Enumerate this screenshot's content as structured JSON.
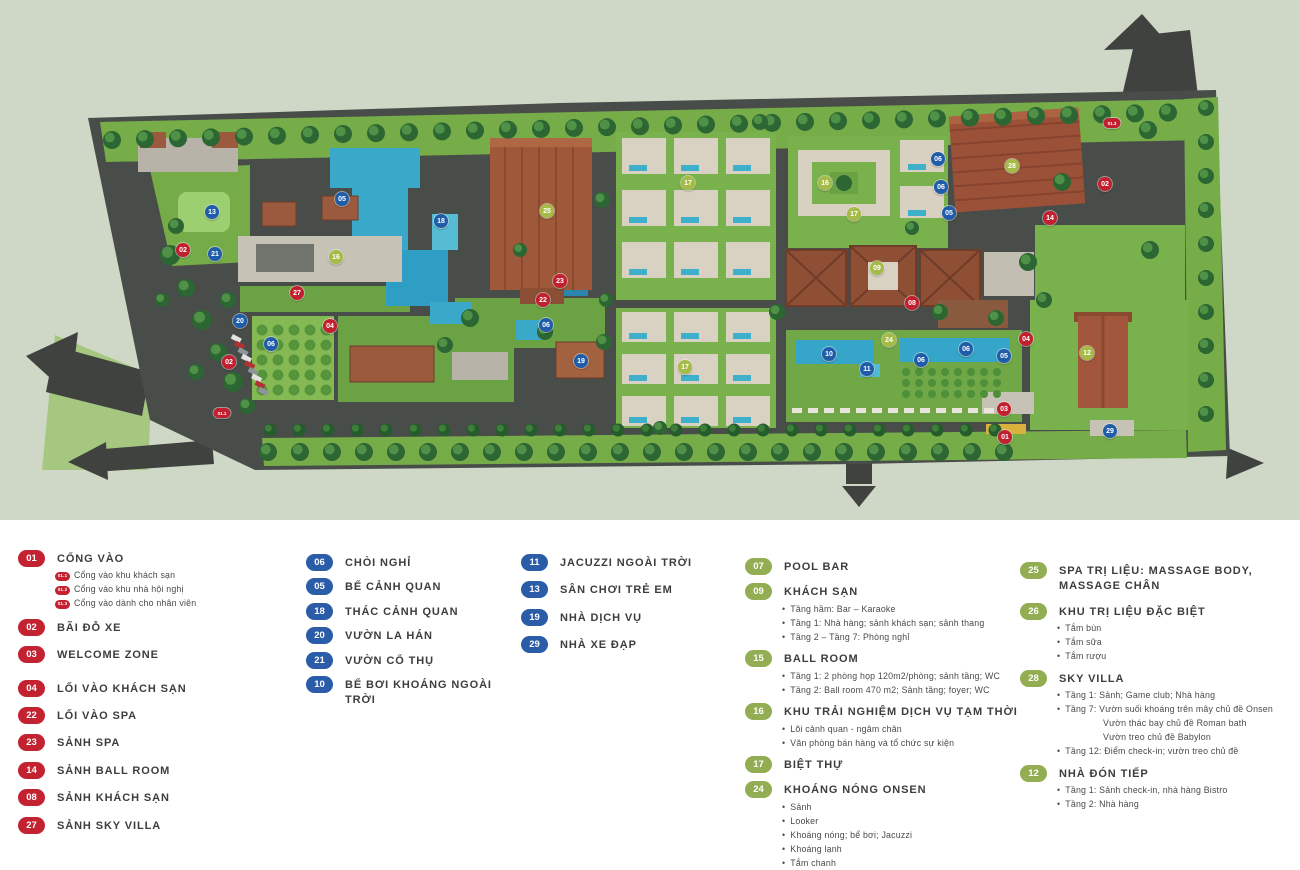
{
  "palette": {
    "map_background": "#cfd8c6",
    "site_ground": "#494d49",
    "lawn_green": "#77ad49",
    "pool_blue": "#3aa9c9",
    "roof_terracotta": "#9b5138",
    "marker_red": "#c3202f",
    "marker_blue": "#1f5dab",
    "marker_green": "#a4bb45",
    "legend_red": "#c32231",
    "legend_blue": "#2a5ca8",
    "legend_green": "#93ad52"
  },
  "map": {
    "markers": [
      {
        "num": "13",
        "color": "blue",
        "x": 212,
        "y": 212
      },
      {
        "num": "21",
        "color": "blue",
        "x": 215,
        "y": 254
      },
      {
        "num": "02",
        "color": "red",
        "x": 183,
        "y": 250
      },
      {
        "num": "02",
        "color": "red",
        "x": 229,
        "y": 362
      },
      {
        "num": "01.1",
        "color": "red",
        "x": 222,
        "y": 413,
        "small": true
      },
      {
        "num": "20",
        "color": "blue",
        "x": 240,
        "y": 321
      },
      {
        "num": "06",
        "color": "blue",
        "x": 271,
        "y": 344
      },
      {
        "num": "27",
        "color": "red",
        "x": 297,
        "y": 293
      },
      {
        "num": "04",
        "color": "red",
        "x": 330,
        "y": 326
      },
      {
        "num": "16",
        "color": "green",
        "x": 336,
        "y": 257
      },
      {
        "num": "05",
        "color": "blue",
        "x": 342,
        "y": 199
      },
      {
        "num": "18",
        "color": "blue",
        "x": 441,
        "y": 221
      },
      {
        "num": "25",
        "color": "green",
        "x": 547,
        "y": 211
      },
      {
        "num": "23",
        "color": "red",
        "x": 560,
        "y": 281
      },
      {
        "num": "22",
        "color": "red",
        "x": 543,
        "y": 300
      },
      {
        "num": "06",
        "color": "blue",
        "x": 546,
        "y": 325
      },
      {
        "num": "19",
        "color": "blue",
        "x": 581,
        "y": 361
      },
      {
        "num": "17",
        "color": "green",
        "x": 688,
        "y": 183
      },
      {
        "num": "17",
        "color": "green",
        "x": 685,
        "y": 367
      },
      {
        "num": "16",
        "color": "green",
        "x": 825,
        "y": 183
      },
      {
        "num": "17",
        "color": "green",
        "x": 854,
        "y": 214
      },
      {
        "num": "06",
        "color": "blue",
        "x": 938,
        "y": 159
      },
      {
        "num": "06",
        "color": "blue",
        "x": 941,
        "y": 187
      },
      {
        "num": "05",
        "color": "blue",
        "x": 949,
        "y": 213
      },
      {
        "num": "09",
        "color": "green",
        "x": 877,
        "y": 268
      },
      {
        "num": "08",
        "color": "red",
        "x": 912,
        "y": 303
      },
      {
        "num": "24",
        "color": "green",
        "x": 889,
        "y": 340
      },
      {
        "num": "10",
        "color": "blue",
        "x": 829,
        "y": 354
      },
      {
        "num": "11",
        "color": "blue",
        "x": 867,
        "y": 369
      },
      {
        "num": "06",
        "color": "blue",
        "x": 921,
        "y": 360
      },
      {
        "num": "06",
        "color": "blue",
        "x": 966,
        "y": 349
      },
      {
        "num": "05",
        "color": "blue",
        "x": 1004,
        "y": 356
      },
      {
        "num": "04",
        "color": "red",
        "x": 1026,
        "y": 339
      },
      {
        "num": "28",
        "color": "green",
        "x": 1012,
        "y": 166
      },
      {
        "num": "14",
        "color": "red",
        "x": 1050,
        "y": 218
      },
      {
        "num": "12",
        "color": "green",
        "x": 1087,
        "y": 353
      },
      {
        "num": "02",
        "color": "red",
        "x": 1105,
        "y": 184
      },
      {
        "num": "01.3",
        "color": "red",
        "x": 1112,
        "y": 123,
        "small": true
      },
      {
        "num": "03",
        "color": "red",
        "x": 1004,
        "y": 409
      },
      {
        "num": "01",
        "color": "red",
        "x": 1005,
        "y": 437
      },
      {
        "num": "29",
        "color": "blue",
        "x": 1110,
        "y": 431
      }
    ]
  },
  "legend": {
    "columns": [
      {
        "items": [
          {
            "num": "01",
            "color": "red",
            "label": "CỔNG VÀO",
            "subs": [
              {
                "badge": "01.1",
                "text": "Cổng vào khu khách sạn"
              },
              {
                "badge": "01.2",
                "text": "Cổng vào khu nhà hội nghị"
              },
              {
                "badge": "01.3",
                "text": "Cổng vào dành cho nhân viên"
              }
            ]
          },
          {
            "num": "02",
            "color": "red",
            "label": "BÃI ĐỖ XE"
          },
          {
            "num": "03",
            "color": "red",
            "label": "WELCOME ZONE",
            "extra_space": true
          },
          {
            "num": "04",
            "color": "red",
            "label": "LỐI VÀO KHÁCH SẠN"
          },
          {
            "num": "22",
            "color": "red",
            "label": "LỐI VÀO SPA"
          },
          {
            "num": "23",
            "color": "red",
            "label": "SẢNH SPA"
          },
          {
            "num": "14",
            "color": "red",
            "label": "SẢNH BALL ROOM"
          },
          {
            "num": "08",
            "color": "red",
            "label": "SẢNH KHÁCH SẠN"
          },
          {
            "num": "27",
            "color": "red",
            "label": "SẢNH SKY VILLA"
          }
        ]
      },
      {
        "items": [
          {
            "num": "06",
            "color": "blue",
            "label": "CHÒI NGHỈ"
          },
          {
            "num": "05",
            "color": "blue",
            "label": "BỂ CẢNH QUAN"
          },
          {
            "num": "18",
            "color": "blue",
            "label": "THÁC CẢNH QUAN"
          },
          {
            "num": "20",
            "color": "blue",
            "label": "VƯỜN LA HÁN"
          },
          {
            "num": "21",
            "color": "blue",
            "label": "VƯỜN CỔ THỤ"
          },
          {
            "num": "10",
            "color": "blue",
            "label": "BỂ BƠI KHOÁNG NGOÀI TRỜI"
          }
        ]
      },
      {
        "items": [
          {
            "num": "11",
            "color": "blue",
            "label": "JACUZZI NGOÀI TRỜI"
          },
          {
            "num": "13",
            "color": "blue",
            "label": "SÂN CHƠI TRẺ EM"
          },
          {
            "num": "19",
            "color": "blue",
            "label": "NHÀ DỊCH VỤ"
          },
          {
            "num": "29",
            "color": "blue",
            "label": "NHÀ XE ĐẠP"
          }
        ]
      },
      {
        "items": [
          {
            "num": "07",
            "color": "green",
            "label": "POOL BAR"
          },
          {
            "num": "09",
            "color": "green",
            "label": "KHÁCH SẠN",
            "subs": [
              {
                "text": "Tầng hầm: Bar – Karaoke"
              },
              {
                "text": "Tầng 1: Nhà hàng; sảnh khách sạn; sảnh thang"
              },
              {
                "text": "Tầng 2 – Tầng 7: Phòng nghỉ"
              }
            ]
          },
          {
            "num": "15",
            "color": "green",
            "label": "BALL ROOM",
            "subs": [
              {
                "text": "Tầng 1: 2 phòng họp 120m2/phòng; sảnh tầng; WC"
              },
              {
                "text": "Tầng 2: Ball room 470 m2; Sảnh tầng; foyer; WC"
              }
            ]
          },
          {
            "num": "16",
            "color": "green",
            "label": "KHU TRẢI NGHIỆM DỊCH VỤ TẠM THỜI",
            "subs": [
              {
                "text": "Lõi cảnh quan - ngâm chân"
              },
              {
                "text": "Văn phòng bán hàng và tổ chức sự kiện"
              }
            ]
          },
          {
            "num": "17",
            "color": "green",
            "label": "BIỆT THỰ"
          },
          {
            "num": "24",
            "color": "green",
            "label": "KHOÁNG NÓNG ONSEN",
            "subs": [
              {
                "text": "Sảnh"
              },
              {
                "text": "Looker"
              },
              {
                "text": "Khoáng nóng; bể bơi; Jacuzzi"
              },
              {
                "text": "Khoáng lạnh"
              },
              {
                "text": "Tắm chanh"
              },
              {
                "text": "Tắm thảo dược"
              }
            ]
          }
        ]
      },
      {
        "items": [
          {
            "num": "25",
            "color": "green",
            "label": "SPA TRỊ LIỆU: MASSAGE BODY, MASSAGE CHÂN"
          },
          {
            "num": "26",
            "color": "green",
            "label": "KHU TRỊ LIỆU ĐẶC BIỆT",
            "subs": [
              {
                "text": "Tắm bùn"
              },
              {
                "text": "Tắm sữa"
              },
              {
                "text": "Tắm rượu"
              }
            ]
          },
          {
            "num": "28",
            "color": "green",
            "label": "SKY VILLA",
            "subs": [
              {
                "text": "Tầng 1: Sảnh; Game club; Nhà hàng"
              },
              {
                "text": "Tầng 7: Vườn suối khoáng trên mây chủ đề Onsen"
              },
              {
                "text": "Vườn thác bay chủ đề Roman bath",
                "indent": true
              },
              {
                "text": "Vườn treo chủ đề Babylon",
                "indent": true
              },
              {
                "text": "Tầng 12: Điểm check-in; vườn treo chủ đề"
              }
            ]
          },
          {
            "num": "12",
            "color": "green",
            "label": "NHÀ ĐÓN TIẾP",
            "subs": [
              {
                "text": "Tầng 1: Sảnh check-in, nhà hàng Bistro"
              },
              {
                "text": "Tầng 2: Nhà hàng"
              }
            ]
          }
        ]
      }
    ]
  }
}
